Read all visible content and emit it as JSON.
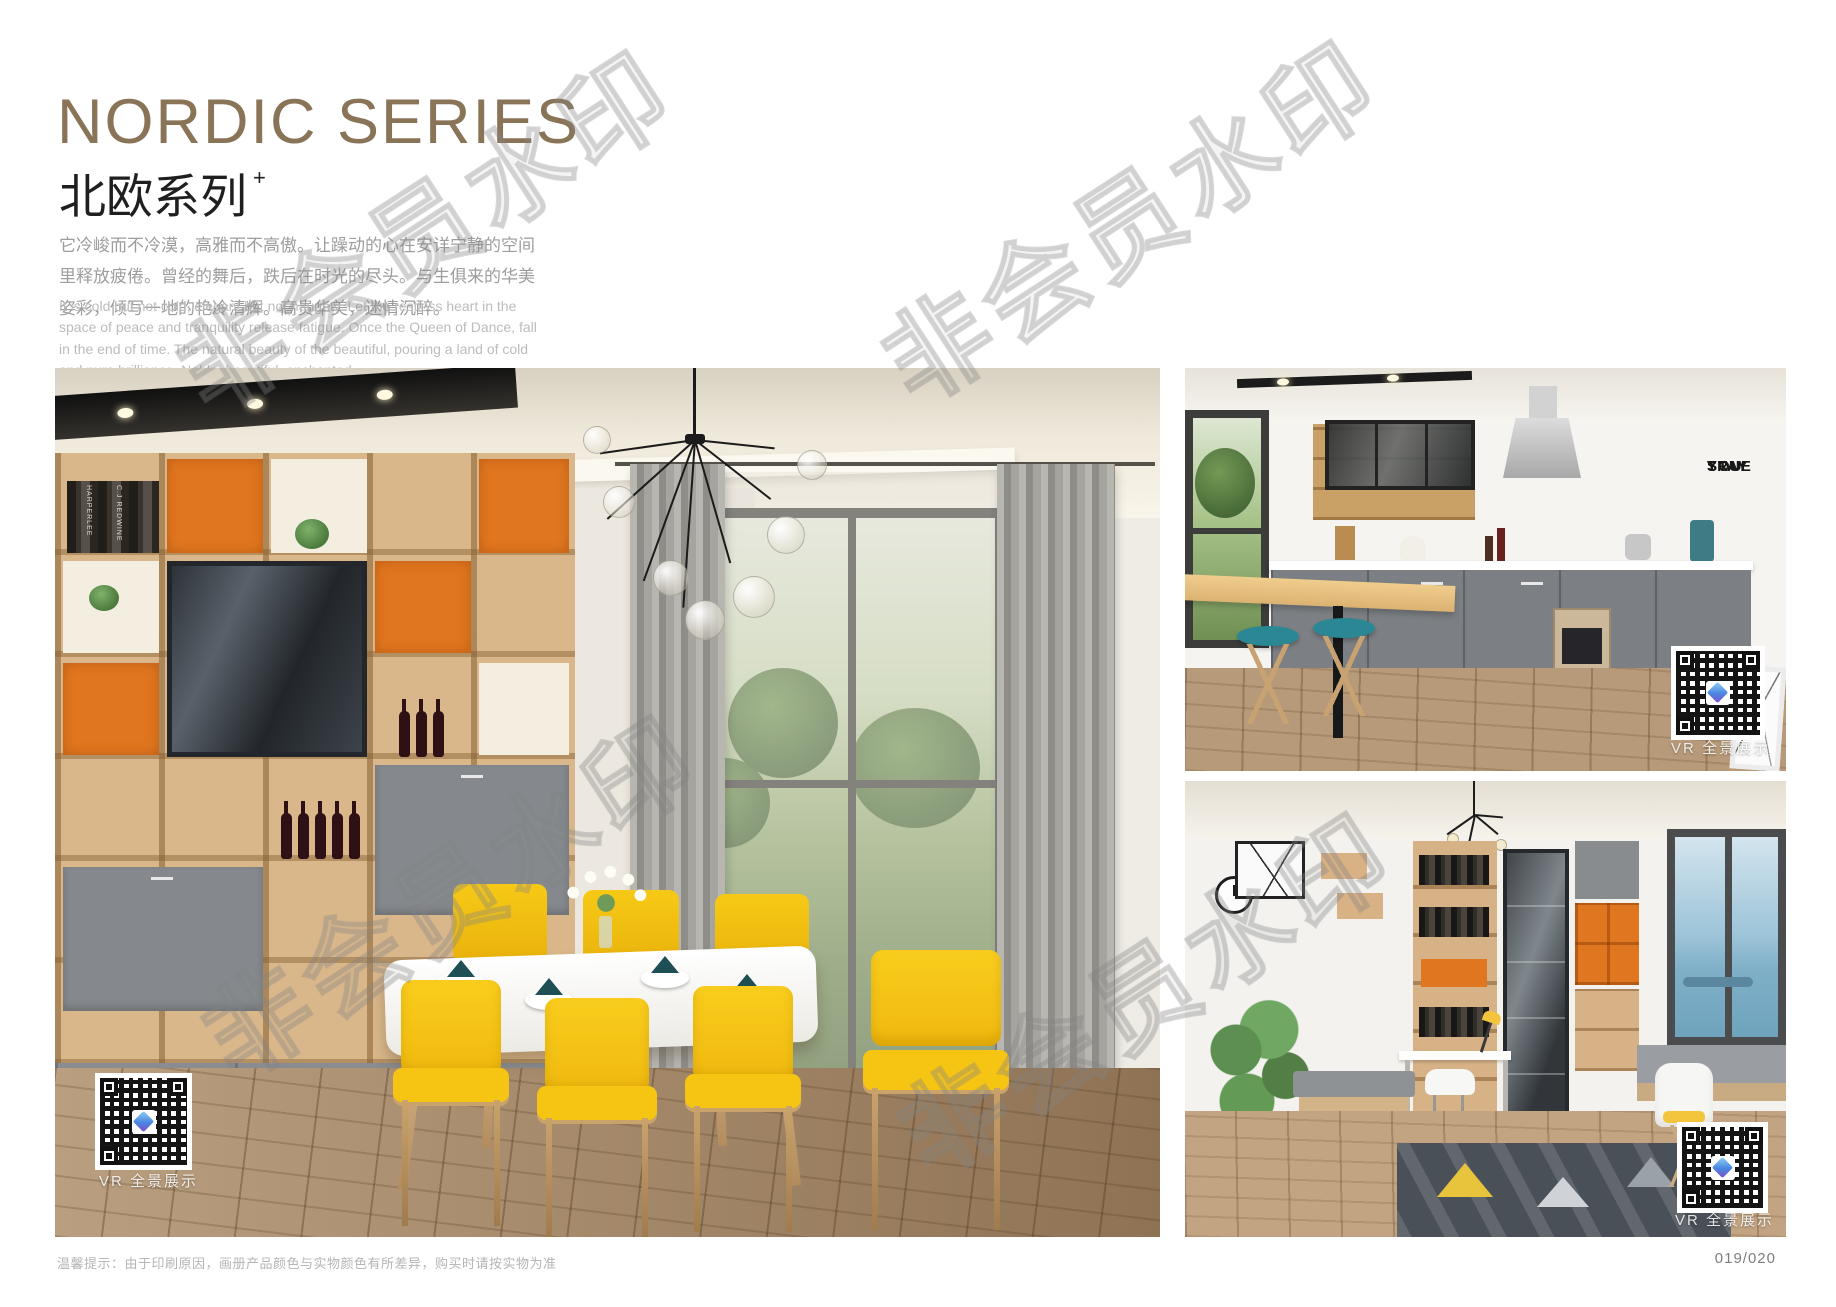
{
  "header": {
    "title_en": "NORDIC SERIES",
    "title_zh": "北欧系列",
    "title_sup": "+",
    "intro_zh": "它冷峻而不冷漠，高雅而不高傲。让躁动的心在安详宁静的空间里释放疲倦。曾经的舞后，跌后在时光的尽头。与生俱来的华美姿彩，倾写一地的艳冷清辉。高贵华美，迷情沉醉。",
    "intro_en": "It is cold but not cold, elegant but not haughty. Let the restless heart in the space of peace and tranquility release fatigue. Once the Queen of Dance, fall in the end of time. The natural beauty of the beautiful, pouring a land of cold and pure brilliance. Noble, beautiful, enchanted."
  },
  "watermark": {
    "text": "非会员水印"
  },
  "photos": {
    "dining_room": {
      "vr_label": "VR 全景展示",
      "book_spines": [
        "HARPERLEE",
        "C.J REDWINE"
      ]
    },
    "kitchen": {
      "vr_label": "VR 全景展示",
      "wall_decor": [
        "STAY",
        "TRUE",
        "STAY",
        "YOU"
      ]
    },
    "study": {
      "vr_label": "VR 全景展示"
    }
  },
  "footer": {
    "note": "温馨提示：由于印刷原因，画册产品颜色与实物颜色有所差异，购买时请按实物为准",
    "page_number": "019/020"
  },
  "colors": {
    "title_brown": "#8a7458",
    "accent_orange": "#e0761f",
    "chair_yellow": "#f6c513",
    "teal_napkin": "#1d4f55"
  }
}
